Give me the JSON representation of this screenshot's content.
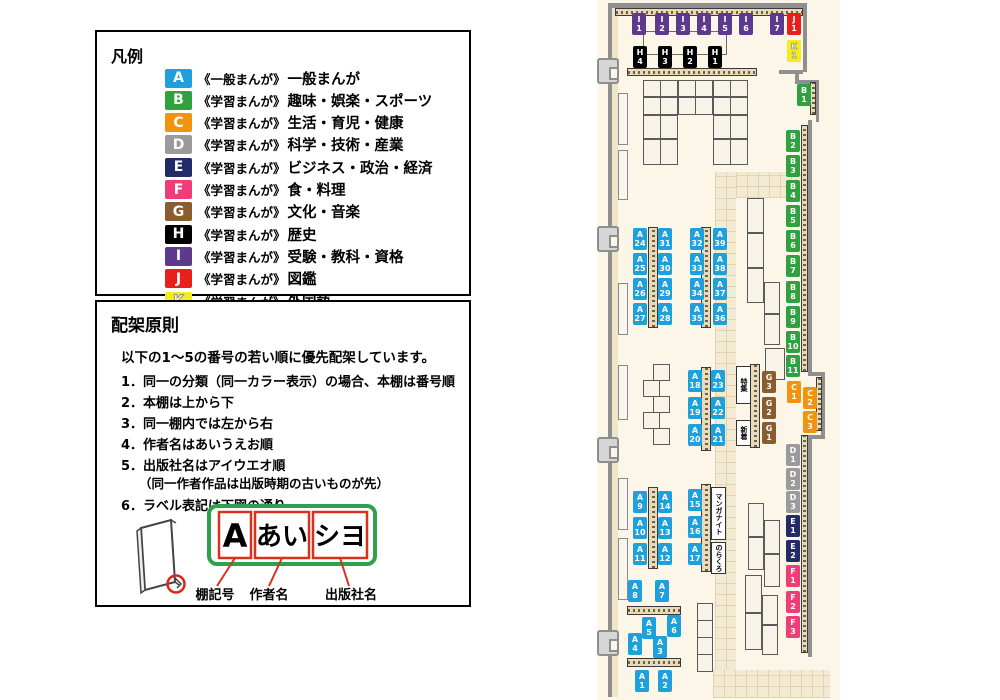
{
  "category_colors": {
    "A": "#1EA0DC",
    "B": "#2FA23F",
    "C": "#F0930F",
    "D": "#9B9B9C",
    "E": "#222A68",
    "F": "#F03C77",
    "G": "#8A5C2E",
    "H": "#000000",
    "I": "#5D3A8E",
    "J": "#E7211A",
    "K": "#F5EC1E"
  },
  "legend": {
    "title": "凡例",
    "items": [
      {
        "code": "A",
        "prefix": "《一般まんが》",
        "label": "一般まんが"
      },
      {
        "code": "B",
        "prefix": "《学習まんが》",
        "label": "趣味・娯楽・スポーツ"
      },
      {
        "code": "C",
        "prefix": "《学習まんが》",
        "label": "生活・育児・健康"
      },
      {
        "code": "D",
        "prefix": "《学習まんが》",
        "label": "科学・技術・産業"
      },
      {
        "code": "E",
        "prefix": "《学習まんが》",
        "label": "ビジネス・政治・経済"
      },
      {
        "code": "F",
        "prefix": "《学習まんが》",
        "label": "食・料理"
      },
      {
        "code": "G",
        "prefix": "《学習まんが》",
        "label": "文化・音楽"
      },
      {
        "code": "H",
        "prefix": "《学習まんが》",
        "label": "歴史"
      },
      {
        "code": "I",
        "prefix": "《学習まんが》",
        "label": "受験・教科・資格"
      },
      {
        "code": "J",
        "prefix": "《学習まんが》",
        "label": "図鑑"
      },
      {
        "code": "K",
        "prefix": "《学習まんが》",
        "label": "外国語"
      }
    ]
  },
  "principles": {
    "title": "配架原則",
    "intro": "以下の1～5の番号の若い順に優先配架しています。",
    "rules": [
      {
        "num": "1",
        "text": "同一の分類（同一カラー表示）の場合、本棚は番号順"
      },
      {
        "num": "2",
        "text": "本棚は上から下"
      },
      {
        "num": "3",
        "text": "同一棚内では左から右"
      },
      {
        "num": "4",
        "text": "作者名はあいうえお順"
      },
      {
        "num": "5",
        "text": "出版社名はアイウエオ順",
        "note": "（同一作者作品は出版時期の古いものが先）"
      },
      {
        "num": "6",
        "text": "ラベル表記は下図の通り"
      }
    ],
    "diagram": {
      "shelf_code": "A",
      "author": "あい",
      "publisher": "シヨ",
      "caption_code": "棚記号",
      "caption_author": "作者名",
      "caption_publisher": "出版社名"
    }
  },
  "map": {
    "shelf_labels": [
      {
        "c": "I",
        "n": "1",
        "x": 35,
        "y": 13
      },
      {
        "c": "I",
        "n": "2",
        "x": 58,
        "y": 13
      },
      {
        "c": "I",
        "n": "3",
        "x": 79,
        "y": 13
      },
      {
        "c": "I",
        "n": "4",
        "x": 100,
        "y": 13
      },
      {
        "c": "I",
        "n": "5",
        "x": 121,
        "y": 13
      },
      {
        "c": "I",
        "n": "6",
        "x": 142,
        "y": 13
      },
      {
        "c": "I",
        "n": "7",
        "x": 173,
        "y": 13
      },
      {
        "c": "J",
        "n": "1",
        "x": 190,
        "y": 13
      },
      {
        "c": "K",
        "n": "1",
        "x": 190,
        "y": 40
      },
      {
        "c": "H",
        "n": "4",
        "x": 36,
        "y": 46
      },
      {
        "c": "H",
        "n": "3",
        "x": 61,
        "y": 46
      },
      {
        "c": "H",
        "n": "2",
        "x": 86,
        "y": 46
      },
      {
        "c": "H",
        "n": "1",
        "x": 111,
        "y": 46
      },
      {
        "c": "B",
        "n": "1",
        "x": 200,
        "y": 84
      },
      {
        "c": "B",
        "n": "2",
        "x": 189,
        "y": 130
      },
      {
        "c": "B",
        "n": "3",
        "x": 189,
        "y": 155
      },
      {
        "c": "B",
        "n": "4",
        "x": 189,
        "y": 180
      },
      {
        "c": "B",
        "n": "5",
        "x": 189,
        "y": 205
      },
      {
        "c": "B",
        "n": "6",
        "x": 189,
        "y": 230
      },
      {
        "c": "B",
        "n": "7",
        "x": 189,
        "y": 255
      },
      {
        "c": "B",
        "n": "8",
        "x": 189,
        "y": 281
      },
      {
        "c": "B",
        "n": "9",
        "x": 189,
        "y": 306
      },
      {
        "c": "B",
        "n": "10",
        "x": 189,
        "y": 331
      },
      {
        "c": "B",
        "n": "11",
        "x": 189,
        "y": 355
      },
      {
        "c": "C",
        "n": "1",
        "x": 190,
        "y": 381
      },
      {
        "c": "C",
        "n": "2",
        "x": 206,
        "y": 387
      },
      {
        "c": "C",
        "n": "3",
        "x": 206,
        "y": 411
      },
      {
        "c": "D",
        "n": "1",
        "x": 189,
        "y": 444
      },
      {
        "c": "D",
        "n": "2",
        "x": 189,
        "y": 468
      },
      {
        "c": "D",
        "n": "3",
        "x": 189,
        "y": 491
      },
      {
        "c": "E",
        "n": "1",
        "x": 189,
        "y": 515
      },
      {
        "c": "E",
        "n": "2",
        "x": 189,
        "y": 540
      },
      {
        "c": "F",
        "n": "1",
        "x": 189,
        "y": 565
      },
      {
        "c": "F",
        "n": "2",
        "x": 189,
        "y": 591
      },
      {
        "c": "F",
        "n": "3",
        "x": 189,
        "y": 616
      },
      {
        "c": "G",
        "n": "3",
        "x": 165,
        "y": 371
      },
      {
        "c": "G",
        "n": "2",
        "x": 165,
        "y": 397
      },
      {
        "c": "G",
        "n": "1",
        "x": 165,
        "y": 422
      },
      {
        "c": "A",
        "n": "24",
        "x": 36,
        "y": 228
      },
      {
        "c": "A",
        "n": "31",
        "x": 61,
        "y": 228
      },
      {
        "c": "A",
        "n": "32",
        "x": 93,
        "y": 228
      },
      {
        "c": "A",
        "n": "39",
        "x": 116,
        "y": 228
      },
      {
        "c": "A",
        "n": "25",
        "x": 36,
        "y": 253
      },
      {
        "c": "A",
        "n": "30",
        "x": 61,
        "y": 253
      },
      {
        "c": "A",
        "n": "33",
        "x": 93,
        "y": 253
      },
      {
        "c": "A",
        "n": "38",
        "x": 116,
        "y": 253
      },
      {
        "c": "A",
        "n": "26",
        "x": 36,
        "y": 278
      },
      {
        "c": "A",
        "n": "29",
        "x": 61,
        "y": 278
      },
      {
        "c": "A",
        "n": "34",
        "x": 93,
        "y": 278
      },
      {
        "c": "A",
        "n": "37",
        "x": 116,
        "y": 278
      },
      {
        "c": "A",
        "n": "27",
        "x": 36,
        "y": 303
      },
      {
        "c": "A",
        "n": "28",
        "x": 61,
        "y": 303
      },
      {
        "c": "A",
        "n": "35",
        "x": 93,
        "y": 303
      },
      {
        "c": "A",
        "n": "36",
        "x": 116,
        "y": 303
      },
      {
        "c": "A",
        "n": "18",
        "x": 91,
        "y": 370
      },
      {
        "c": "A",
        "n": "23",
        "x": 114,
        "y": 370
      },
      {
        "c": "A",
        "n": "19",
        "x": 91,
        "y": 397
      },
      {
        "c": "A",
        "n": "22",
        "x": 114,
        "y": 397
      },
      {
        "c": "A",
        "n": "20",
        "x": 91,
        "y": 424
      },
      {
        "c": "A",
        "n": "21",
        "x": 114,
        "y": 424
      },
      {
        "c": "A",
        "n": "9",
        "x": 36,
        "y": 491
      },
      {
        "c": "A",
        "n": "14",
        "x": 61,
        "y": 491
      },
      {
        "c": "A",
        "n": "15",
        "x": 91,
        "y": 489
      },
      {
        "c": "A",
        "n": "10",
        "x": 36,
        "y": 517
      },
      {
        "c": "A",
        "n": "13",
        "x": 61,
        "y": 517
      },
      {
        "c": "A",
        "n": "16",
        "x": 91,
        "y": 516
      },
      {
        "c": "A",
        "n": "11",
        "x": 36,
        "y": 543
      },
      {
        "c": "A",
        "n": "12",
        "x": 61,
        "y": 543
      },
      {
        "c": "A",
        "n": "17",
        "x": 91,
        "y": 543
      },
      {
        "c": "A",
        "n": "8",
        "x": 31,
        "y": 580
      },
      {
        "c": "A",
        "n": "7",
        "x": 58,
        "y": 580
      },
      {
        "c": "A",
        "n": "5",
        "x": 45,
        "y": 617
      },
      {
        "c": "A",
        "n": "6",
        "x": 70,
        "y": 615
      },
      {
        "c": "A",
        "n": "4",
        "x": 31,
        "y": 633
      },
      {
        "c": "A",
        "n": "3",
        "x": 56,
        "y": 636
      },
      {
        "c": "A",
        "n": "1",
        "x": 38,
        "y": 670
      },
      {
        "c": "A",
        "n": "2",
        "x": 61,
        "y": 670
      }
    ],
    "features": [
      {
        "text": "特集",
        "x": 139,
        "y": 366,
        "w": 15,
        "h": 38
      },
      {
        "text": "新着",
        "x": 139,
        "y": 420,
        "w": 15,
        "h": 26
      },
      {
        "text": "マンガナイト",
        "x": 114,
        "y": 487,
        "w": 15,
        "h": 53
      },
      {
        "text": "のらくろ",
        "x": 114,
        "y": 542,
        "w": 15,
        "h": 32
      }
    ],
    "doors_y": [
      58,
      226,
      437,
      630
    ]
  }
}
